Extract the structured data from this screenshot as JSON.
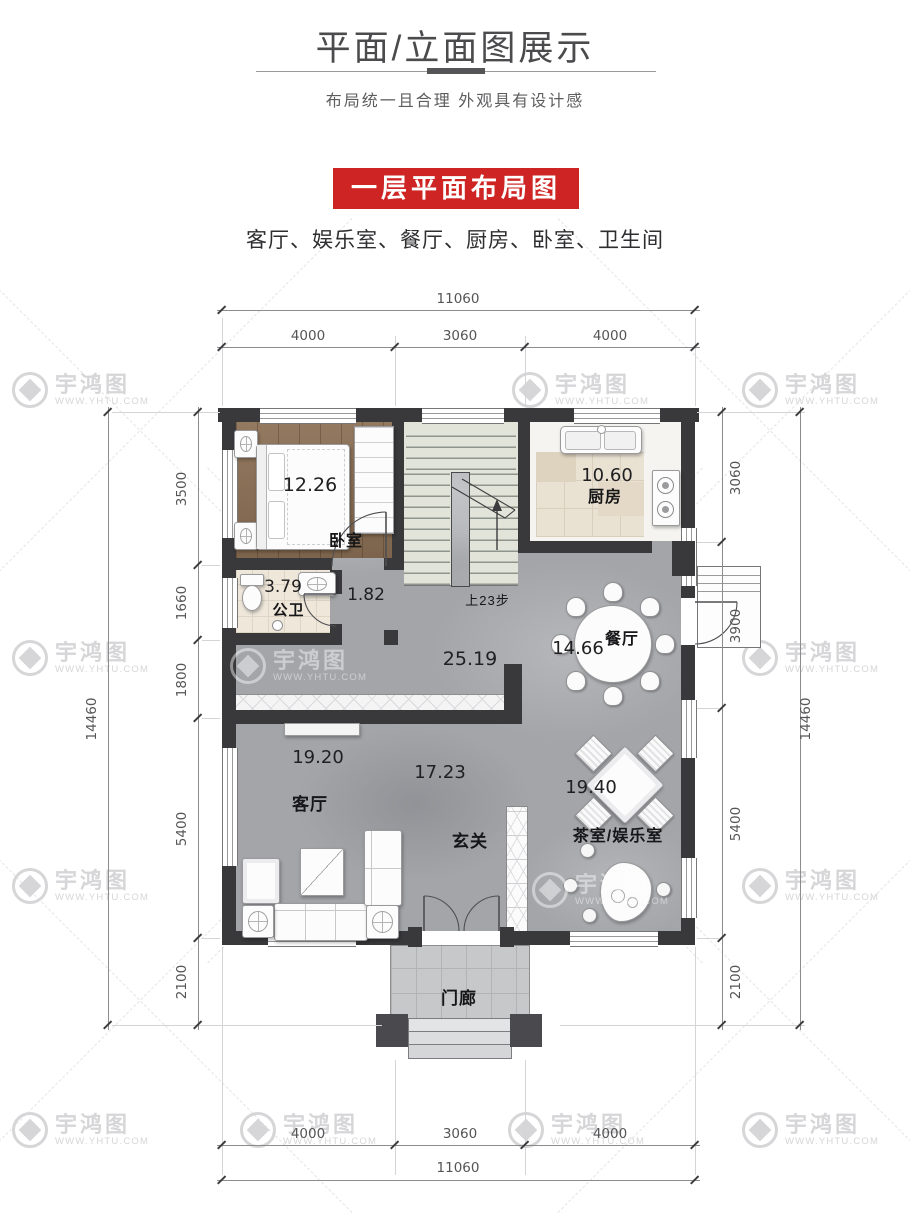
{
  "header": {
    "title": "平面/立面图展示",
    "subtitle": "布局统一且合理  外观具有设计感",
    "banner": "一层平面布局图",
    "banner_color": "#ce2424",
    "room_list": "客厅、娱乐室、餐厅、厨房、卧室、卫生间"
  },
  "watermark": {
    "brand": "宇鸿图",
    "url": "WWW.YHTU.COM"
  },
  "plan": {
    "rooms": {
      "bedroom": {
        "name": "卧室",
        "area": "12.26"
      },
      "kitchen": {
        "name": "厨房",
        "area": "10.60"
      },
      "bathroom": {
        "name": "公卫",
        "area": "3.79"
      },
      "corridor": {
        "area": "1.82"
      },
      "hall": {
        "area": "25.19"
      },
      "dining": {
        "name": "餐厅",
        "area": "14.66"
      },
      "living": {
        "name": "客厅",
        "area_left": "19.20",
        "area_right": "17.23"
      },
      "foyer": {
        "name": "玄关"
      },
      "tea_room": {
        "name": "茶室/娱乐室",
        "area": "19.40"
      },
      "porch": {
        "name": "门廊"
      }
    },
    "stairs_note": "上23步",
    "dims": {
      "top": {
        "total": "11060",
        "segs": [
          "4000",
          "3060",
          "4000"
        ]
      },
      "bottom": {
        "total": "11060",
        "segs": [
          "4000",
          "3060",
          "4000"
        ]
      },
      "left": {
        "total": "14460",
        "segs": [
          "3500",
          "1660",
          "1800",
          "5400",
          "2100"
        ]
      },
      "right": {
        "total": "14460",
        "segs": [
          "3060",
          "3900",
          "5400",
          "2100"
        ]
      }
    }
  }
}
